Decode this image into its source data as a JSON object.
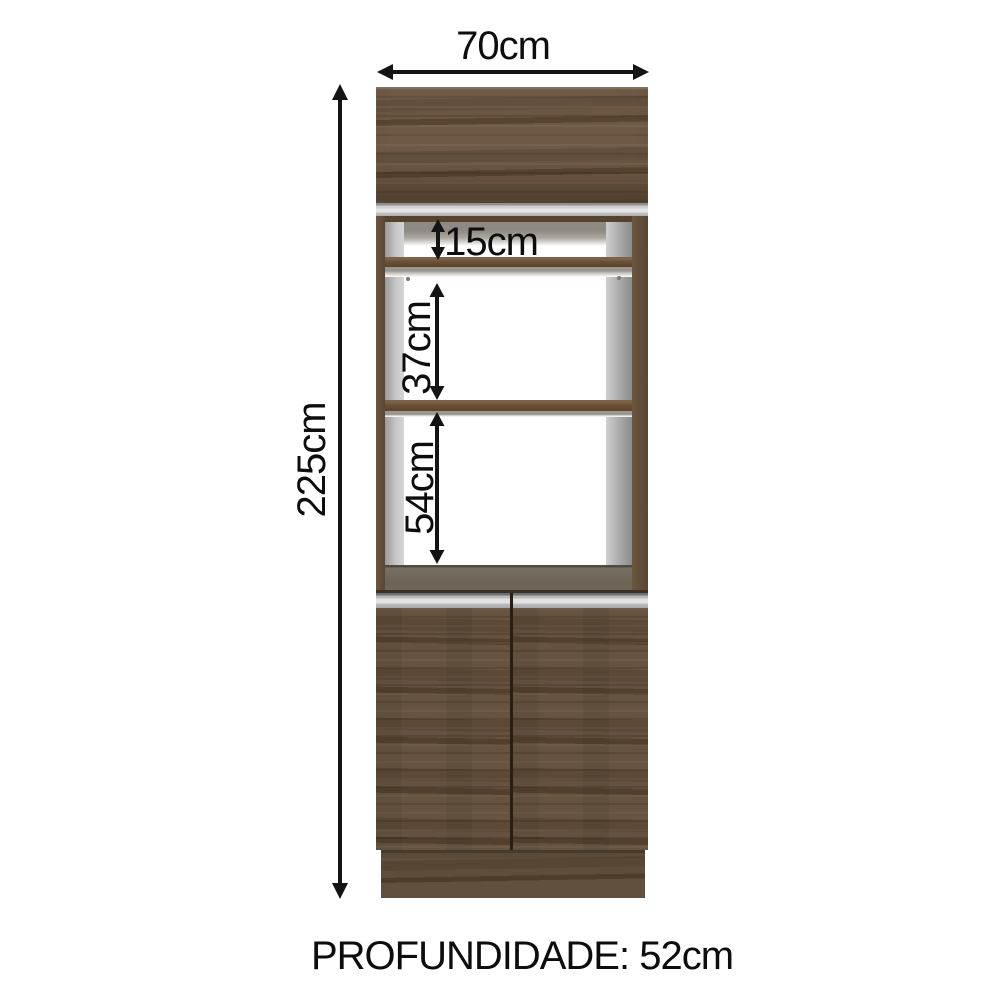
{
  "diagram": {
    "dimensions": {
      "width": "70cm",
      "height": "225cm",
      "top_niche_height": "15cm",
      "middle_niche_height": "37cm",
      "bottom_niche_height": "54cm"
    },
    "depth_caption": "PROFUNDIDADE: 52cm",
    "colors": {
      "wood_brown": "#65513d",
      "wood_dark_grain": "#57452f",
      "carcass_gray": "#d2d2d2",
      "inner_wall_gray": "#a8a8a8",
      "niche_floor": "#6b6456",
      "dimension_black": "#141414",
      "background": "#ffffff"
    }
  }
}
